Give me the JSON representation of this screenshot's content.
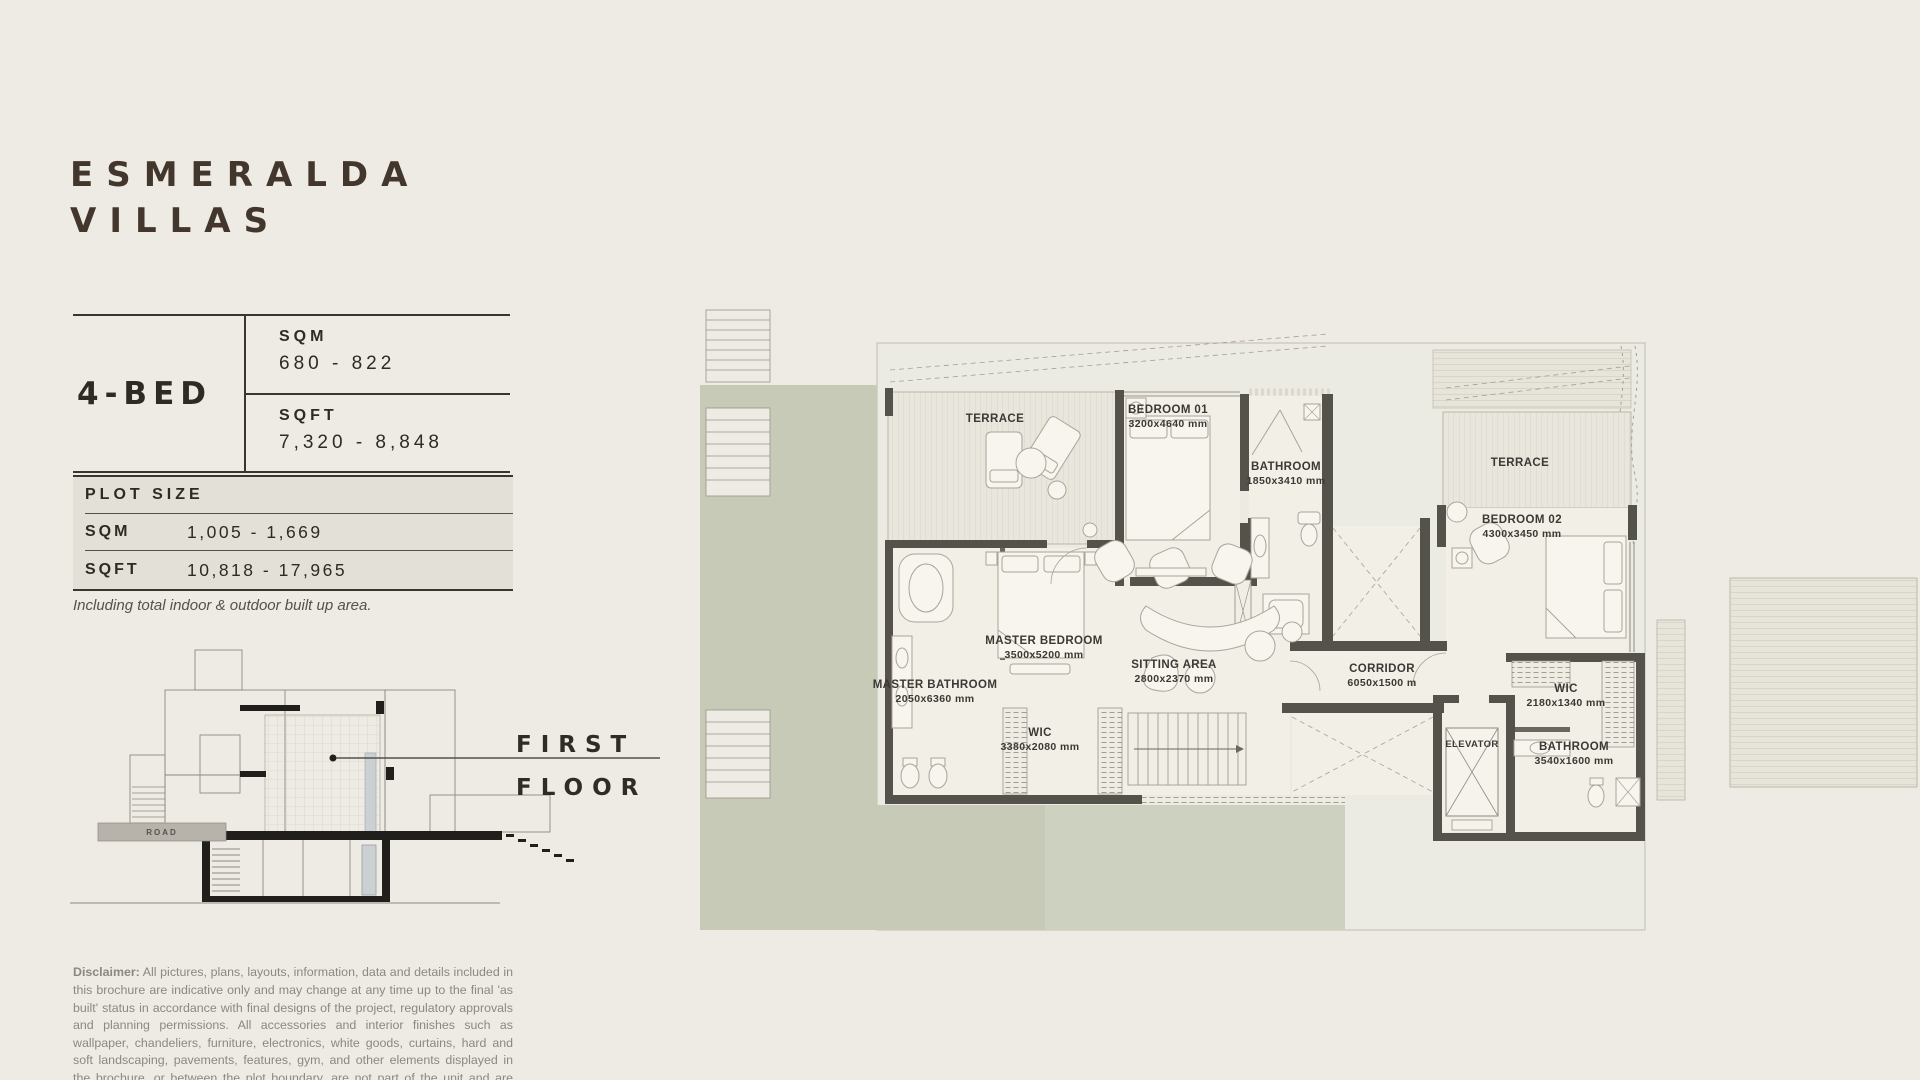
{
  "brand": {
    "title_line1": "ESMERALDA",
    "title_line2": "VILLAS"
  },
  "unit": {
    "type": "4-BED",
    "sqm_label": "SQM",
    "sqm_value": "680 - 822",
    "sqft_label": "SQFT",
    "sqft_value": "7,320 - 8,848"
  },
  "plot": {
    "title": "PLOT SIZE",
    "rows": [
      {
        "label": "SQM",
        "value": "1,005 - 1,669"
      },
      {
        "label": "SQFT",
        "value": "10,818 - 17,965"
      }
    ],
    "note": "Including total indoor & outdoor built up area."
  },
  "floor_label": {
    "line1": "FIRST",
    "line2": "FLOOR"
  },
  "section": {
    "road_label": "ROAD"
  },
  "disclaimer": {
    "bold": "Disclaimer:",
    "text": " All pictures, plans, layouts, information, data and details included in this brochure are indicative only and may change at any time up to the final 'as built' status in accordance with final designs of the project, regulatory approvals and planning permissions. All accessories and interior finishes such as wallpaper, chandeliers, furniture, electronics, white goods, curtains, hard and soft landscaping, pavements, features, gym, and other elements displayed in the brochure, or between the plot boundary, are not part of the unit and are shown for illustrative purposes only."
  },
  "plan": {
    "rooms": [
      {
        "name": "TERRACE",
        "dims": ""
      },
      {
        "name": "BEDROOM 01",
        "dims": "3200x4640 mm"
      },
      {
        "name": "BATHROOM",
        "dims": "1850x3410 mm"
      },
      {
        "name": "TERRACE",
        "dims": ""
      },
      {
        "name": "BEDROOM 02",
        "dims": "4300x3450 mm"
      },
      {
        "name": "MASTER BEDROOM",
        "dims": "3500x5200 mm"
      },
      {
        "name": "SITTING AREA",
        "dims": "2800x2370 mm"
      },
      {
        "name": "MASTER BATHROOM",
        "dims": "2050x6360 mm"
      },
      {
        "name": "WIC",
        "dims": "3380x2080 mm"
      },
      {
        "name": "CORRIDOR",
        "dims": "6050x1500 m"
      },
      {
        "name": "ELEVATOR",
        "dims": ""
      },
      {
        "name": "WIC",
        "dims": "2180x1340 mm"
      },
      {
        "name": "BATHROOM",
        "dims": "3540x1600 mm"
      }
    ]
  },
  "colors": {
    "page_bg": "#EDEBE4",
    "ink": "#2E2A24",
    "brand_brown": "#43362C",
    "plot_bg": "#E3E0D8",
    "muted_text": "#8D887E",
    "landscape_green": "#C6CAB7",
    "wall_gray": "#55524B",
    "floor": "#F2EFE7"
  }
}
